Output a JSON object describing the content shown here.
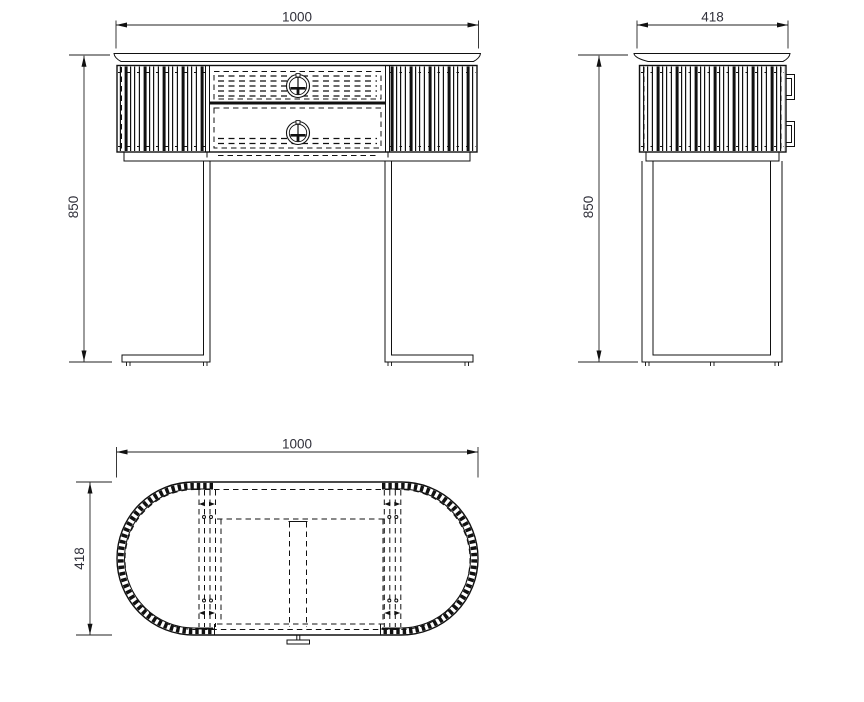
{
  "drawing": {
    "background": "#ffffff",
    "line_color": "#111111",
    "text_color": "#30303a",
    "units": "mm",
    "views": {
      "front": {
        "width_dim": "1000",
        "height_dim": "850"
      },
      "side": {
        "width_dim": "418",
        "height_dim": "850"
      },
      "plan": {
        "width_dim": "1000",
        "depth_dim": "418"
      }
    },
    "dimensions_mm": {
      "width": 1000,
      "depth": 418,
      "height": 850
    }
  }
}
